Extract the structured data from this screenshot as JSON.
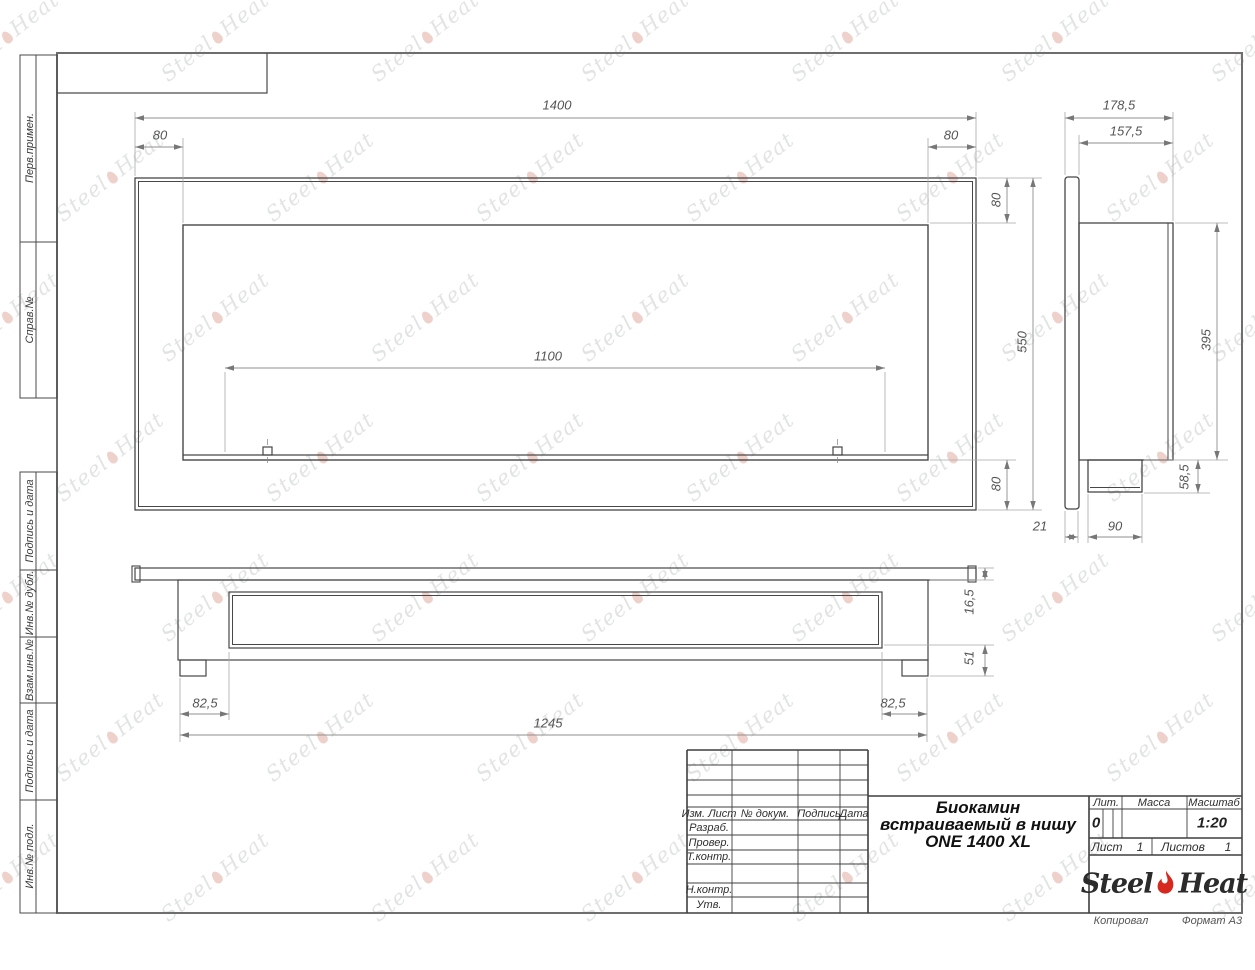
{
  "margins": {
    "labels": [
      "Перв.примен.",
      "Справ.№",
      "Подпись и дата",
      "Инв.№ дубл.",
      "Взам.инв.№",
      "Подпись и дата",
      "Инв.№ подл."
    ]
  },
  "dims": {
    "d1400": "1400",
    "d80": "80",
    "d1100": "1100",
    "d550": "550",
    "d178_5": "178,5",
    "d157_5": "157,5",
    "d395": "395",
    "d58_5": "58,5",
    "d21": "21",
    "d90": "90",
    "d16_5": "16,5",
    "d51": "51",
    "d82_5": "82,5",
    "d1245": "1245"
  },
  "title_block": {
    "header_izm": "Изм. Лист",
    "header_doc": "№ докум.",
    "header_sign": "Подпись",
    "header_date": "Дата",
    "row_razrab": "Разраб.",
    "row_prover": "Провер.",
    "row_tkontr": "Т.контр.",
    "row_nkontr": "Н.контр.",
    "row_utv": "Утв.",
    "title_line1": "Биокамин",
    "title_line2": "встраиваемый в нишу",
    "title_line3": "ONE 1400 XL",
    "lit_label": "Лит.",
    "lit_value": "0",
    "massa_label": "Масса",
    "scale_label": "Масштаб",
    "scale_value": "1:20",
    "sheet_label": "Лист",
    "sheet_value": "1",
    "sheets_label": "Листов",
    "sheets_value": "1",
    "brand_steel": "Steel",
    "brand_heat": "Heat"
  },
  "sheet": {
    "kopiroval": "Копировал",
    "format_note": "Формат А3"
  },
  "watermark": {
    "steel": "Steel",
    "heat": "Heat"
  }
}
